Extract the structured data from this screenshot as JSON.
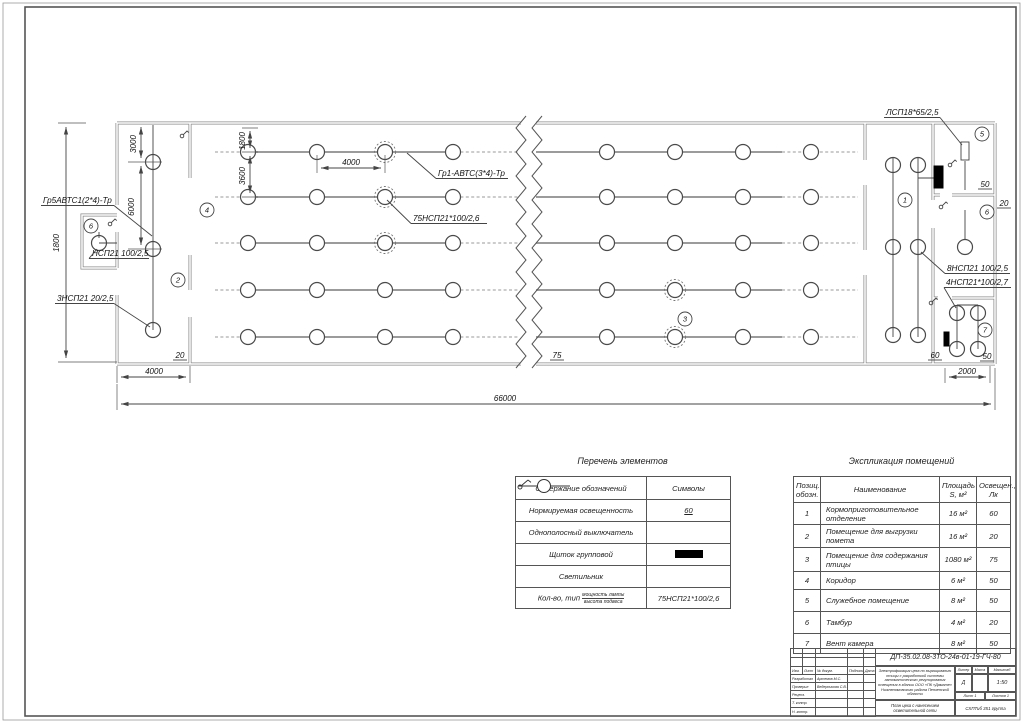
{
  "sheet": {
    "doc_number": "ДП-35.02.08-3ТО-24в-01-19-ГЧ-80"
  },
  "plan": {
    "labels": {
      "gr5": "Гр5АВТС1(2*4)-Тр",
      "nsp_100": "НСП21 100/2,5",
      "nsp_20": "3НСП21 20/2,5",
      "gr1": "Гр1-АВТС(3*4)-Тр",
      "nsp_75": "75НСП21*100/2,6",
      "lsp18": "ЛСП18*65/2,5",
      "nsp_8": "8НСП21 100/2,5",
      "nsp_4": "4НСП21*100/2,7"
    },
    "dims": {
      "height": "1800",
      "d3000": "3000",
      "d6000": "6000",
      "row1": "1800",
      "row2": "3600",
      "lamp_step": "4000",
      "corridor": "4000",
      "right_room": "2000",
      "total": "66000"
    },
    "lux": {
      "corridor": "20",
      "hall": "75",
      "room5": "50",
      "room6": "20",
      "room7a": "60",
      "room7b": "50"
    },
    "rooms": {
      "r1": "1",
      "r2": "2",
      "r3": "3",
      "r4": "4",
      "r5": "5",
      "r6_left": "6",
      "r6_right": "6",
      "r7": "7"
    }
  },
  "legend": {
    "title": "Перечень элементов",
    "col1": "Содержание обозначений",
    "col2": "Символы",
    "rows": [
      {
        "name": "Нормируемая освещенность",
        "symbol_text": "60"
      },
      {
        "name": "Однополосный выключатель"
      },
      {
        "name": "Щиток групповой"
      },
      {
        "name": "Светильник"
      },
      {
        "name": "Кол-во, тип",
        "name_small_top": "мощность лампы",
        "name_small_bottom": "высота подвеса",
        "symbol_text": "75НСП21*100/2,6"
      }
    ]
  },
  "explication": {
    "title": "Экспликация помещений",
    "headers": {
      "pos": "Позиц.\nобозн.",
      "name": "Наименование",
      "area": "Площадь\nS, м²",
      "lux": "Освещен.,\nЛк"
    },
    "rows": [
      {
        "pos": "1",
        "name": "Кормоприготовительное отделение",
        "area": "16 м²",
        "lux": "60"
      },
      {
        "pos": "2",
        "name": "Помещение для выгрузки помета",
        "area": "16 м²",
        "lux": "20"
      },
      {
        "pos": "3",
        "name": "Помещение для содержания птицы",
        "area": "1080 м²",
        "lux": "75"
      },
      {
        "pos": "4",
        "name": "Коридор",
        "area": "6 м²",
        "lux": "50"
      },
      {
        "pos": "5",
        "name": "Служебное помещение",
        "area": "8 м²",
        "lux": "50"
      },
      {
        "pos": "6",
        "name": "Тамбур",
        "area": "4 м²",
        "lux": "20"
      },
      {
        "pos": "7",
        "name": "Вент камера",
        "area": "8 м²",
        "lux": "50"
      }
    ]
  },
  "titleblock": {
    "doc_number": "ДП-35.02.08-3ТО-24в-01-19-ГЧ-80",
    "cols": [
      "Изм.",
      "Лист",
      "№ докум.",
      "Подпись",
      "Дата"
    ],
    "rows": [
      {
        "role": "Разработал",
        "name": "Артемов М.С."
      },
      {
        "role": "Проверил",
        "name": "Ведерникова С.В."
      },
      {
        "role": "Реценз.",
        "name": ""
      },
      {
        "role": "Т. контр.",
        "name": ""
      },
      {
        "role": "Н. контр.",
        "name": ""
      }
    ],
    "description": "Электрификация цеха по выращиванию птицы с разработкой системы автоматического регулирования освещения в здании ООО «ПК «Дамате» Нижнеломовского района Пензенской области",
    "drawing_title": "План цеха с нанесением осветительной сети",
    "liter_label": "Литер",
    "liter": "Д",
    "massa_label": "Масса",
    "scale_label": "Масштаб",
    "scale": "1:50",
    "sheet": "Лист 1",
    "sheets": "Листов 1",
    "group": "СХПТиб 351 группа"
  }
}
